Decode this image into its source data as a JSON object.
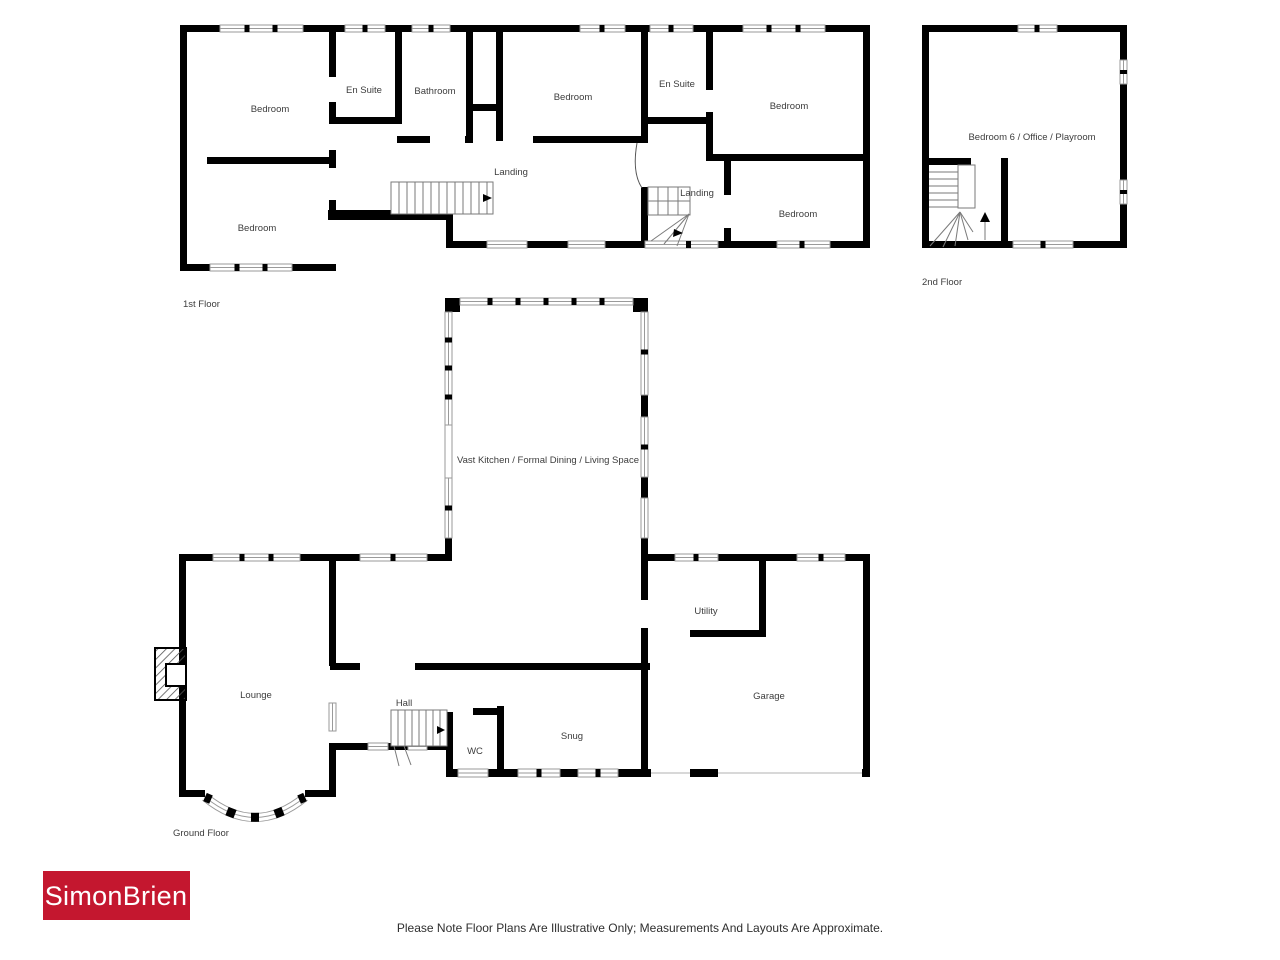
{
  "first_floor": {
    "caption": "1st Floor",
    "labels": {
      "bedroom_top_left": "Bedroom",
      "en_suite_left": "En Suite",
      "bathroom": "Bathroom",
      "bedroom_middle": "Bedroom",
      "en_suite_right": "En Suite",
      "bedroom_top_right": "Bedroom",
      "landing_left": "Landing",
      "landing_right": "Landing",
      "bedroom_bottom_left": "Bedroom",
      "bedroom_bottom_right": "Bedroom"
    }
  },
  "second_floor": {
    "caption": "2nd Floor",
    "labels": {
      "bedroom_office": "Bedroom 6 / Office / Playroom"
    }
  },
  "ground_floor": {
    "caption": "Ground Floor",
    "labels": {
      "kitchen": "Vast Kitchen / Formal Dining / Living Space",
      "lounge": "Lounge",
      "hall": "Hall",
      "wc": "WC",
      "snug": "Snug",
      "utility": "Utility",
      "garage": "Garage"
    }
  },
  "branding": {
    "logo_text": "SimonBrien",
    "logo_bg": "#c4172f",
    "logo_text_color": "#ffffff"
  },
  "disclaimer": "Please Note Floor Plans Are Illustrative Only; Measurements And Layouts Are Approximate."
}
